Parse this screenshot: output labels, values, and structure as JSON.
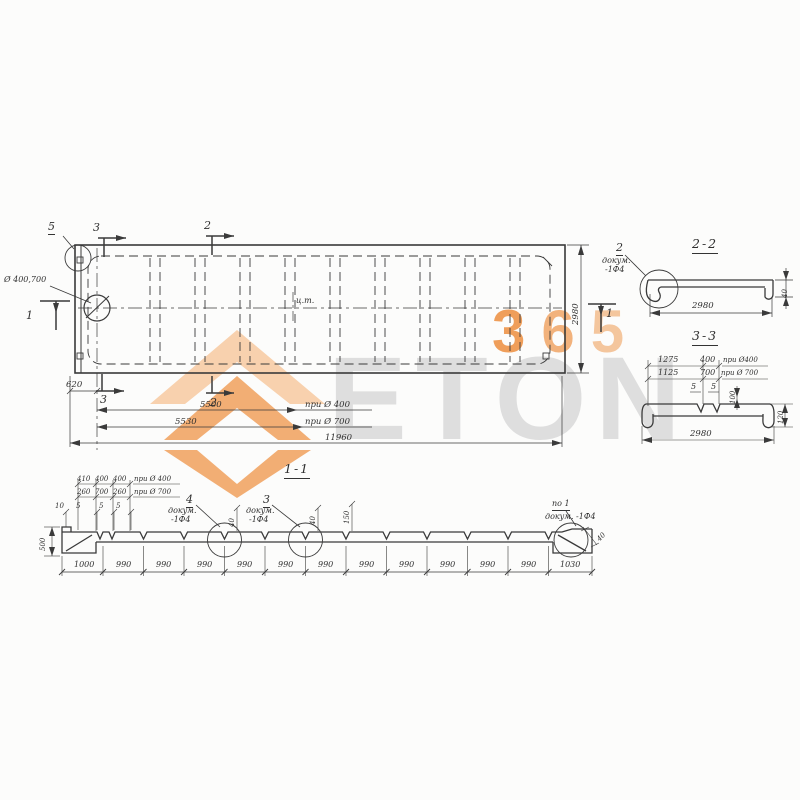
{
  "colors": {
    "accent_orange": "#ef9a52",
    "light_orange": "#f7c9a0",
    "watermark_gray": "#dedede",
    "line": "#3a3a3a"
  },
  "watermark": {
    "word": "ETON",
    "badge_digits": [
      "3",
      "6",
      "5"
    ]
  },
  "plan": {
    "callout5": "5",
    "top_marker3": "3",
    "top_marker2": "2",
    "left_marker1": "1",
    "right_marker1": "1",
    "bottom_marker3": "3",
    "bottom_marker2": "2",
    "hole_label": "Ø 400,700",
    "centroid": "ц.т.",
    "dim_620": "620",
    "dim_5500": "5500",
    "note_400": "при Ø 400",
    "dim_5530": "5530",
    "note_700": "при Ø 700",
    "dim_total": "11960",
    "dim_width": "2980"
  },
  "section22": {
    "title": "2-2",
    "callout2": "2",
    "doc_line1": "докум.",
    "doc_line2": "-1Ф4",
    "dim_width": "2980",
    "dim_flange": "40"
  },
  "section33": {
    "title": "3-3",
    "dim_1275": "1275",
    "dim_400": "400",
    "note_400": "при Ø400",
    "dim_1125": "1125",
    "dim_700": "700",
    "note_700": "при Ø 700",
    "dim_5_left": "5",
    "dim_5_right": "5",
    "dim_100": "100",
    "dim_120": "120",
    "dim_width": "2980"
  },
  "section11": {
    "title": "1-1",
    "row1": [
      "410",
      "400",
      "400"
    ],
    "row1_note": "при Ø 400",
    "row2": [
      "260",
      "700",
      "260"
    ],
    "row2_note": "при Ø 700",
    "row3": [
      "10",
      "5",
      "5",
      "5"
    ],
    "dim_left_height": "500",
    "callout4": "4",
    "callout4_doc1": "докум.",
    "callout4_doc2": "-1Ф4",
    "callout3": "3",
    "callout3_doc1": "докум.",
    "callout3_doc2": "-1Ф4",
    "po1": "по 1",
    "po1_doc": "докум. -1Ф4",
    "notch_dims": [
      "40",
      "40",
      "150"
    ],
    "dim_right_flange": "40",
    "bottom_dims": [
      "1000",
      "990",
      "990",
      "990",
      "990",
      "990",
      "990",
      "990",
      "990",
      "990",
      "990",
      "990",
      "1030"
    ]
  }
}
